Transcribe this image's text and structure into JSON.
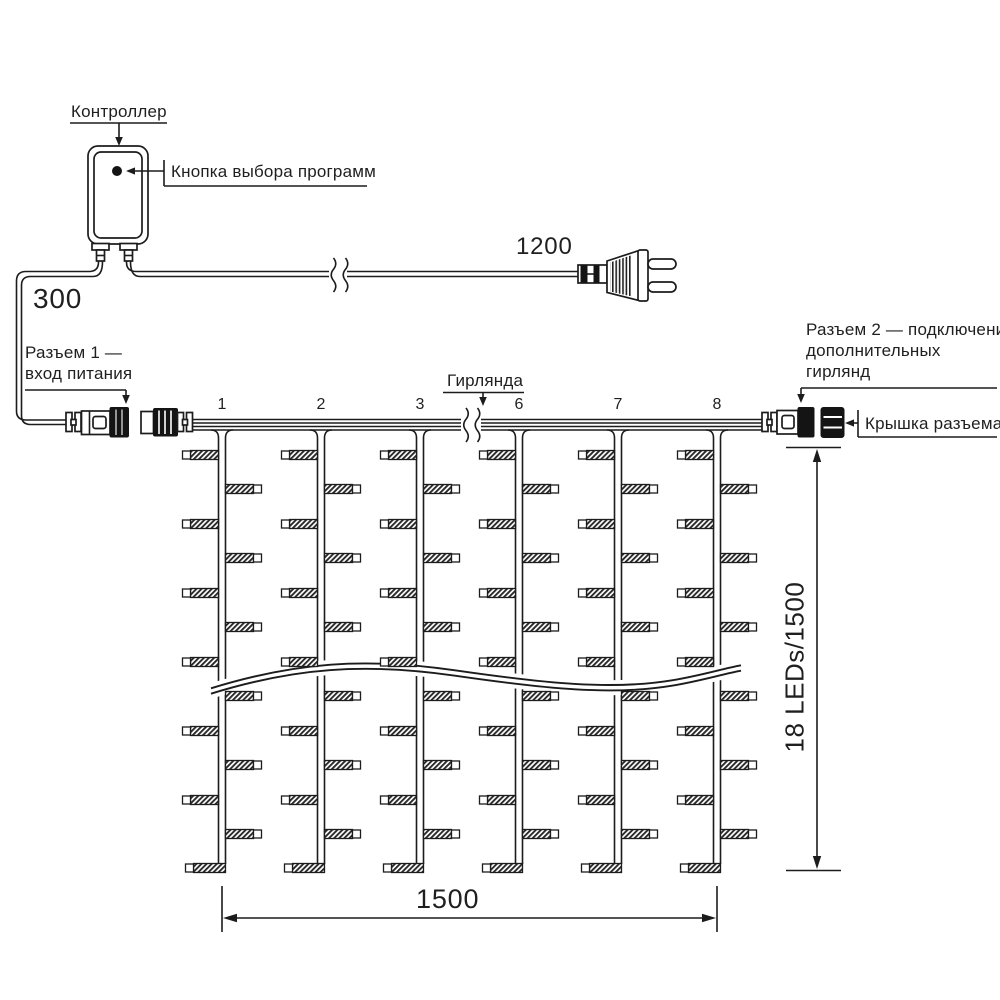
{
  "labels": {
    "controller": "Контроллер",
    "program_button": "Кнопка выбора программ",
    "connector1_line1": "Разъем 1 —",
    "connector1_line2": "вход питания",
    "garland": "Гирлянда",
    "connector2_line1": "Разъем 2 — подключение",
    "connector2_line2": "дополнительных",
    "connector2_line3": "гирлянд",
    "connector_cap": "Крышка разъема"
  },
  "dimensions": {
    "controller_cable": "300",
    "power_cord": "1200",
    "curtain_width": "1500",
    "curtain_height": "18 LEDs/1500"
  },
  "drops": {
    "numbers": [
      "1",
      "2",
      "3",
      "6",
      "7",
      "8"
    ]
  },
  "colors": {
    "line": "#1c1c1c",
    "background": "#ffffff"
  }
}
